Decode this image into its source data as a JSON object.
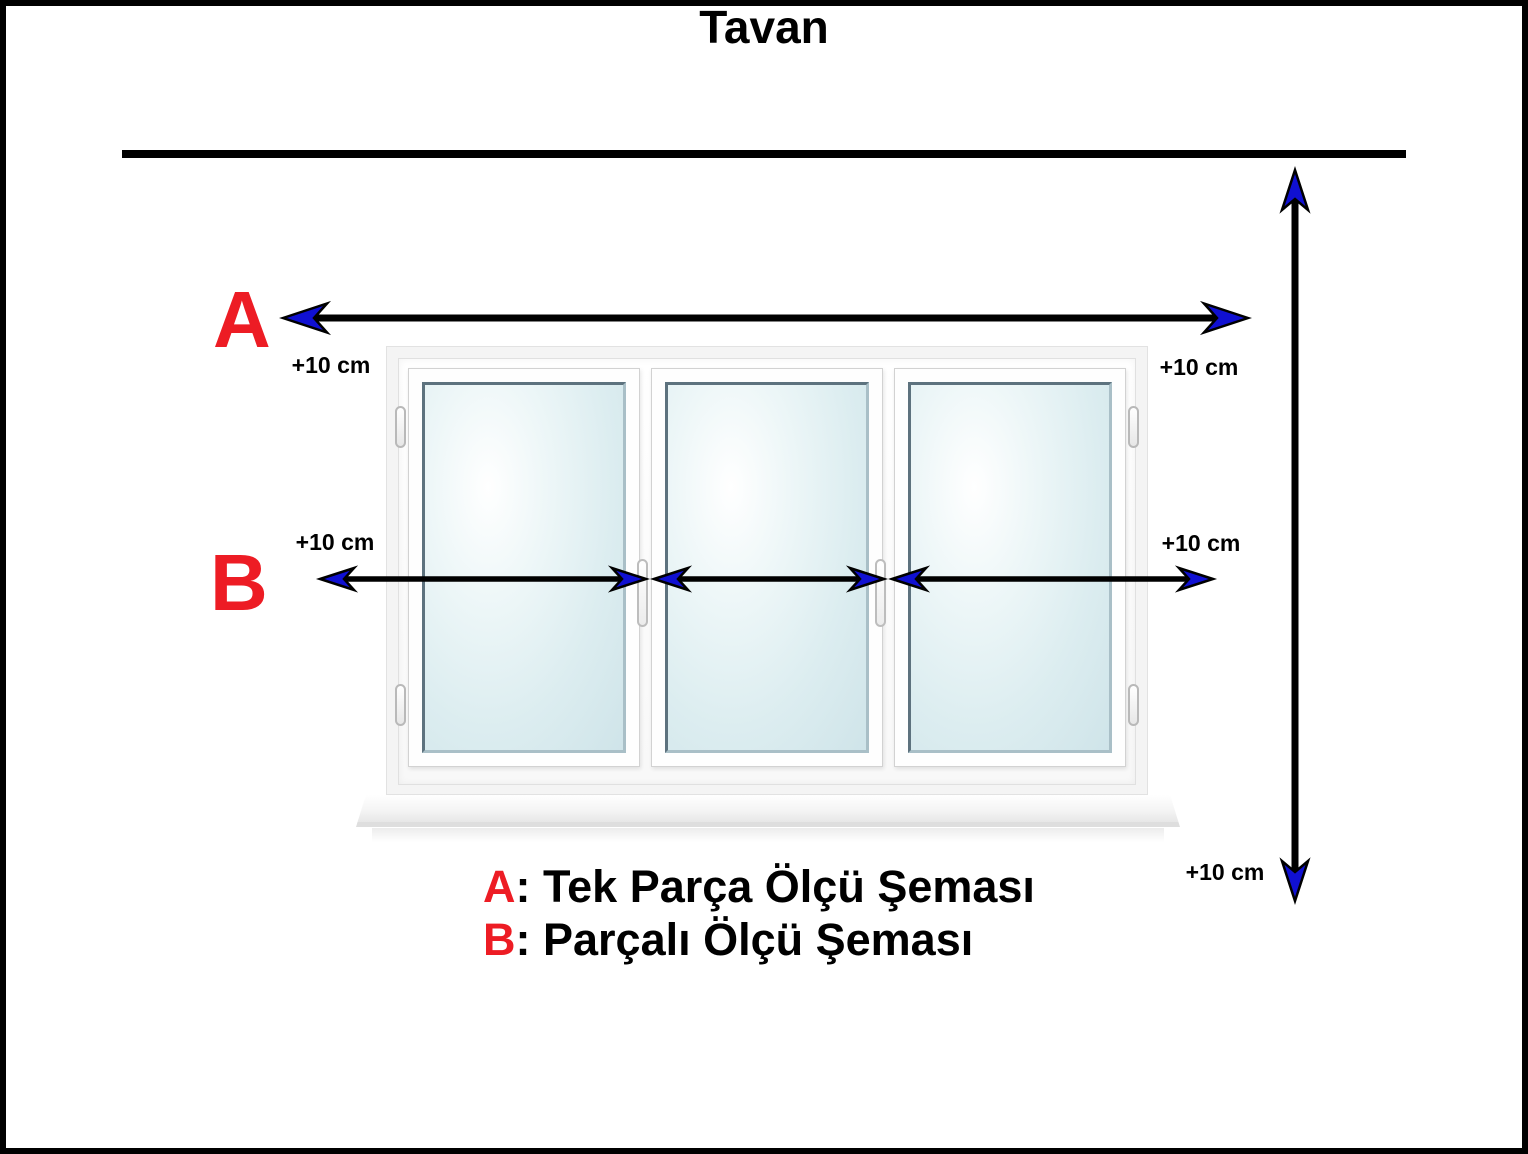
{
  "title": "Tavan",
  "section_a": {
    "marker": "A",
    "label_left": "+10 cm",
    "label_right": "+10 cm"
  },
  "section_b": {
    "marker": "B",
    "label_left": "+10 cm",
    "label_right": "+10 cm",
    "gap_label_1": "0 cm",
    "gap_label_2": "0 cm"
  },
  "height_arrow": {
    "label_bottom": "+10 cm"
  },
  "legend": {
    "a_key": "A",
    "a_text": ": Tek Parça Ölçü Şeması",
    "b_key": "B",
    "b_text": ": Parçalı Ölçü Şeması"
  },
  "colors": {
    "marker_red": "#ed1c24",
    "arrowhead_blue": "#1010d2",
    "line_black": "#000000"
  }
}
